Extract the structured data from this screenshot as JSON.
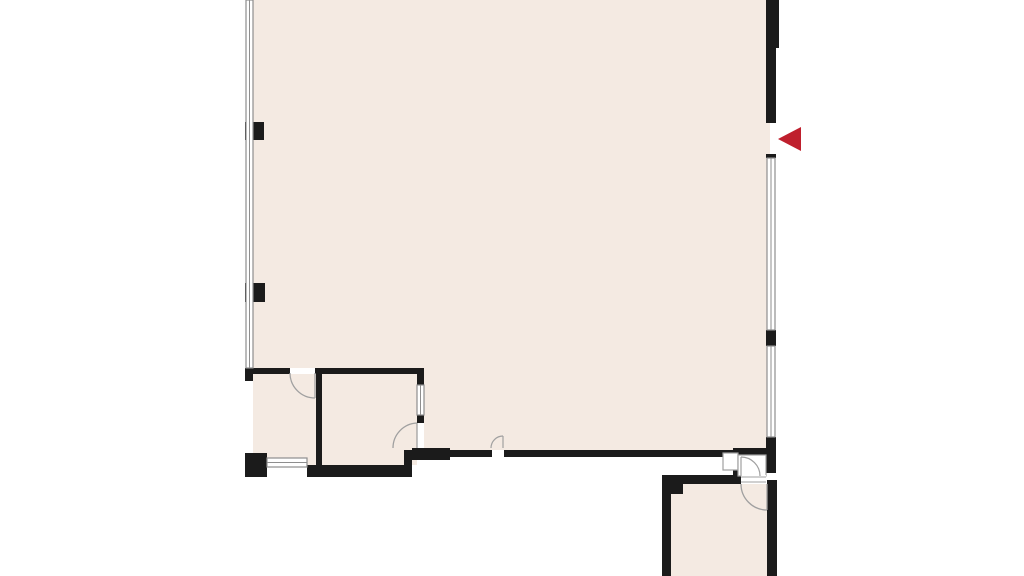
{
  "app": {
    "title": "Floor plan view",
    "description": "2D architectural floor plan of a large open room with two small rooms at the bottom-left, an exit vestibule and a lower-right room, and a red entry-direction arrow marker on the right wall opening"
  },
  "palette": {
    "background": "#ffffff",
    "floor": "#f4eae2",
    "wall": "#1b1b1b",
    "window_stroke": "#8e8e8e",
    "door_stroke": "#a0a0a0",
    "marker_red": "#bf1f2d",
    "white": "#ffffff"
  },
  "canvas": {
    "width": 1024,
    "height": 576
  },
  "marker": {
    "name": "entry-arrow-marker",
    "shape": "triangle-left",
    "points": "801,127 778,139 801,151",
    "fill": "marker_red"
  },
  "floorplan": {
    "shapes": [
      {
        "type": "path",
        "name": "main-room-floor",
        "d": "M253,0 L770,0 L770,452 L420,452 L420,370 L253,370 Z",
        "fill": "floor"
      },
      {
        "type": "rect",
        "name": "room-bottom-left-1-floor",
        "x": 253,
        "y": 370,
        "w": 63,
        "h": 95,
        "fill": "floor"
      },
      {
        "type": "rect",
        "name": "room-bottom-left-2-floor",
        "x": 322,
        "y": 370,
        "w": 95,
        "h": 95,
        "fill": "floor"
      },
      {
        "type": "rect",
        "name": "room-bottom-right-floor",
        "x": 671,
        "y": 484,
        "w": 98,
        "h": 92,
        "fill": "floor"
      },
      {
        "type": "rect",
        "name": "wall-right-top-outer",
        "x": 766,
        "y": 0,
        "w": 13,
        "h": 48,
        "fill": "wall"
      },
      {
        "type": "rect",
        "name": "wall-right-top",
        "x": 766,
        "y": 48,
        "w": 10,
        "h": 75,
        "fill": "wall"
      },
      {
        "type": "rect",
        "name": "wall-right-window-cap",
        "x": 766,
        "y": 154,
        "w": 10,
        "h": 4,
        "fill": "wall"
      },
      {
        "type": "rect",
        "name": "wall-right-mullion",
        "x": 766,
        "y": 330,
        "w": 10,
        "h": 16,
        "fill": "wall"
      },
      {
        "type": "rect",
        "name": "wall-right-mid",
        "x": 766,
        "y": 437,
        "w": 10,
        "h": 36,
        "fill": "wall"
      },
      {
        "type": "rect",
        "name": "wall-right-bottom",
        "x": 767,
        "y": 480,
        "w": 10,
        "h": 96,
        "fill": "wall"
      },
      {
        "type": "rect",
        "name": "wall-bottom-main-left",
        "x": 410,
        "y": 450,
        "w": 82,
        "h": 7,
        "fill": "wall"
      },
      {
        "type": "rect",
        "name": "wall-bottom-main-right",
        "x": 504,
        "y": 450,
        "w": 229,
        "h": 7,
        "fill": "wall"
      },
      {
        "type": "rect",
        "name": "wall-step-vertical",
        "x": 404,
        "y": 450,
        "w": 8,
        "h": 27,
        "fill": "wall"
      },
      {
        "type": "rect",
        "name": "wall-corner-chunk",
        "x": 412,
        "y": 448,
        "w": 38,
        "h": 12,
        "fill": "wall"
      },
      {
        "type": "rect",
        "name": "wall-bottom-band-left",
        "x": 307,
        "y": 465,
        "w": 100,
        "h": 12,
        "fill": "wall"
      },
      {
        "type": "rect",
        "name": "wall-corner-block-bottom-left",
        "x": 245,
        "y": 453,
        "w": 22,
        "h": 24,
        "fill": "wall"
      },
      {
        "type": "rect",
        "name": "wall-rooms-top-left",
        "x": 247,
        "y": 368,
        "w": 43,
        "h": 6,
        "fill": "wall"
      },
      {
        "type": "rect",
        "name": "wall-rooms-top-right",
        "x": 315,
        "y": 368,
        "w": 103,
        "h": 6,
        "fill": "wall"
      },
      {
        "type": "rect",
        "name": "wall-left-junction-block",
        "x": 245,
        "y": 368,
        "w": 8,
        "h": 13,
        "fill": "wall"
      },
      {
        "type": "rect",
        "name": "wall-rooms-divider",
        "x": 316,
        "y": 374,
        "w": 6,
        "h": 91,
        "fill": "wall"
      },
      {
        "type": "rect",
        "name": "wall-room2-corner-top",
        "x": 417,
        "y": 368,
        "w": 7,
        "h": 17,
        "fill": "wall"
      },
      {
        "type": "rect",
        "name": "wall-room2-mullion",
        "x": 417,
        "y": 415,
        "w": 7,
        "h": 9,
        "fill": "wall"
      },
      {
        "type": "rect",
        "name": "wall-left-pier-upper",
        "x": 245,
        "y": 122,
        "w": 19,
        "h": 18,
        "fill": "wall"
      },
      {
        "type": "rect",
        "name": "wall-left-pier-lower",
        "x": 245,
        "y": 283,
        "w": 20,
        "h": 19,
        "fill": "wall"
      },
      {
        "type": "rect",
        "name": "wall-bottom-right-room-top",
        "x": 662,
        "y": 475,
        "w": 79,
        "h": 9,
        "fill": "wall"
      },
      {
        "type": "rect",
        "name": "wall-bottom-right-room-left",
        "x": 662,
        "y": 475,
        "w": 9,
        "h": 101,
        "fill": "wall"
      },
      {
        "type": "rect",
        "name": "wall-bottom-right-room-notch",
        "x": 671,
        "y": 484,
        "w": 12,
        "h": 10,
        "fill": "wall"
      },
      {
        "type": "rect",
        "name": "wall-over-exit-door",
        "x": 733,
        "y": 448,
        "w": 33,
        "h": 7,
        "fill": "wall"
      },
      {
        "type": "rect",
        "name": "wall-post-below-exit-jamb",
        "x": 733,
        "y": 470,
        "w": 9,
        "h": 7,
        "fill": "wall"
      },
      {
        "type": "rect",
        "name": "window-left",
        "x": 246,
        "y": 0,
        "w": 7,
        "h": 368,
        "fill": "white",
        "stroke": "window_stroke",
        "sw": 1.2
      },
      {
        "type": "path",
        "name": "window-left-midline",
        "d": "M249.5,0 L249.5,368",
        "stroke": "window_stroke",
        "sw": 1
      },
      {
        "type": "rect",
        "name": "window-right-upper",
        "x": 767,
        "y": 158,
        "w": 8,
        "h": 172,
        "fill": "white",
        "stroke": "window_stroke",
        "sw": 1.2
      },
      {
        "type": "path",
        "name": "window-right-upper-midline",
        "d": "M771,158 L771,330",
        "stroke": "window_stroke",
        "sw": 1
      },
      {
        "type": "rect",
        "name": "window-right-lower",
        "x": 767,
        "y": 346,
        "w": 8,
        "h": 91,
        "fill": "white",
        "stroke": "window_stroke",
        "sw": 1.2
      },
      {
        "type": "path",
        "name": "window-right-lower-midline",
        "d": "M771,346 L771,437",
        "stroke": "window_stroke",
        "sw": 1
      },
      {
        "type": "rect",
        "name": "window-room2-right",
        "x": 417,
        "y": 385,
        "w": 7,
        "h": 30,
        "fill": "white",
        "stroke": "window_stroke",
        "sw": 1.2
      },
      {
        "type": "path",
        "name": "window-room2-right-midline",
        "d": "M420.5,385 L420.5,415",
        "stroke": "window_stroke",
        "sw": 1
      },
      {
        "type": "rect",
        "name": "window-bottom-left",
        "x": 267,
        "y": 458,
        "w": 40,
        "h": 9,
        "fill": "white",
        "stroke": "window_stroke",
        "sw": 1.2
      },
      {
        "type": "path",
        "name": "window-bottom-left-midline",
        "d": "M267,462.5 L307,462.5",
        "stroke": "window_stroke",
        "sw": 1
      },
      {
        "type": "rect",
        "name": "door-gap-room1-top",
        "x": 290,
        "y": 368,
        "w": 25,
        "h": 6,
        "fill": "white"
      },
      {
        "type": "rect",
        "name": "door-gap-small-bottom",
        "x": 492,
        "y": 450,
        "w": 12,
        "h": 7,
        "fill": "white"
      },
      {
        "type": "rect",
        "name": "door-gap-room2-right",
        "x": 417,
        "y": 423,
        "w": 7,
        "h": 25,
        "fill": "white"
      },
      {
        "type": "rect",
        "name": "exit-door-sidelight",
        "x": 723,
        "y": 453,
        "w": 15,
        "h": 17,
        "fill": "white",
        "stroke": "door_stroke",
        "sw": 1.2
      },
      {
        "type": "rect",
        "name": "exit-door-cell",
        "x": 738,
        "y": 455,
        "w": 28,
        "h": 21,
        "fill": "white",
        "stroke": "door_stroke",
        "sw": 1.2
      },
      {
        "type": "rect",
        "name": "door-gap-bottom-right-room",
        "x": 741,
        "y": 475,
        "w": 25,
        "h": 9,
        "fill": "white"
      },
      {
        "type": "path",
        "name": "door-sill-bottom-right-room-a",
        "d": "M741,477 L766,477",
        "stroke": "door_stroke",
        "sw": 1
      },
      {
        "type": "path",
        "name": "door-sill-bottom-right-room-b",
        "d": "M741,482 L766,482",
        "stroke": "door_stroke",
        "sw": 1
      },
      {
        "type": "path",
        "name": "door-leaf-room1",
        "d": "M315,373 L315,398",
        "stroke": "door_stroke",
        "sw": 1.3
      },
      {
        "type": "path",
        "name": "door-arc-room1",
        "d": "M290,373 A25,25 0 0 0 315,398",
        "stroke": "door_stroke",
        "sw": 1.3
      },
      {
        "type": "path",
        "name": "door-leaf-room2",
        "d": "M417,423 L417,448",
        "stroke": "door_stroke",
        "sw": 1.3
      },
      {
        "type": "path",
        "name": "door-arc-room2",
        "d": "M417,423 A25,25 0 0 0 393,448",
        "stroke": "door_stroke",
        "sw": 1.3
      },
      {
        "type": "path",
        "name": "door-leaf-small-bottom",
        "d": "M503,436 L503,448",
        "stroke": "door_stroke",
        "sw": 1.2
      },
      {
        "type": "path",
        "name": "door-arc-small-bottom",
        "d": "M503,436 A12,12 0 0 0 491,448",
        "stroke": "door_stroke",
        "sw": 1.2
      },
      {
        "type": "path",
        "name": "door-leaf-exit",
        "d": "M741,457 L741,476",
        "stroke": "door_stroke",
        "sw": 1.2
      },
      {
        "type": "path",
        "name": "door-arc-exit",
        "d": "M741,457 A19,19 0 0 1 760,476",
        "stroke": "door_stroke",
        "sw": 1.2
      },
      {
        "type": "path",
        "name": "door-leaf-bottom-right-room",
        "d": "M767,484 L767,510",
        "stroke": "door_stroke",
        "sw": 1.3
      },
      {
        "type": "path",
        "name": "door-arc-bottom-right-room",
        "d": "M741,484 A26,26 0 0 0 767,510",
        "stroke": "door_stroke",
        "sw": 1.3
      }
    ]
  }
}
